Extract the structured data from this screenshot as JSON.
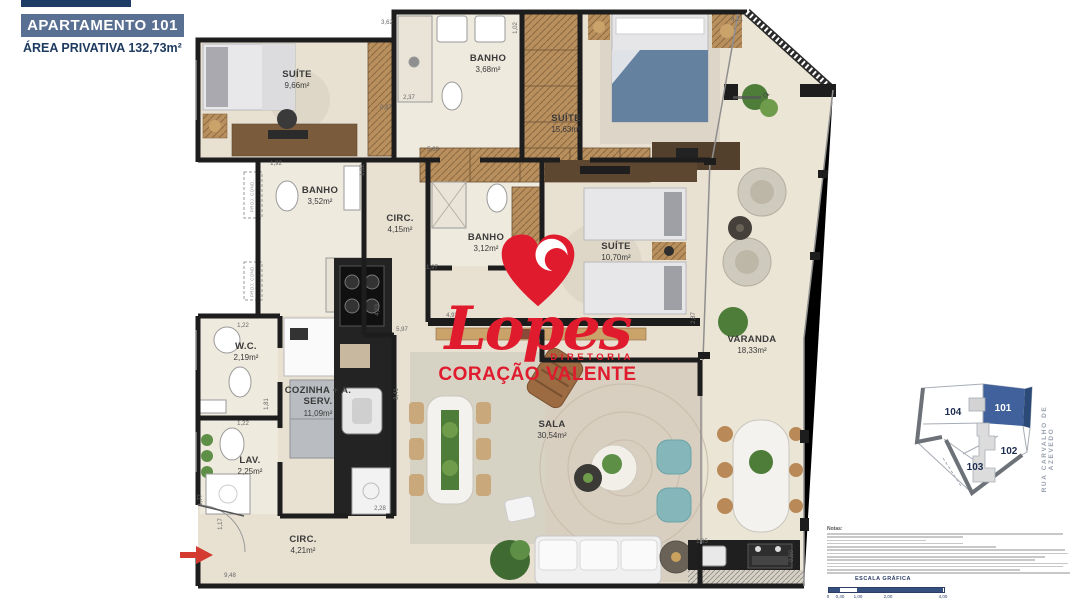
{
  "header": {
    "title": "APARTAMENTO 101",
    "subtitle": "ÁREA PRIVATIVA 132,73m²"
  },
  "logo": {
    "brand": "Lopes",
    "tagline_top": "DIRETORIA",
    "tagline_bottom": "CORAÇÃO VALENTE",
    "color": "#e11b2e"
  },
  "rooms": [
    {
      "name": "SUÍTE",
      "area": "9,66m²",
      "x": 297,
      "y": 80
    },
    {
      "name": "BANHO",
      "area": "3,68m²",
      "x": 488,
      "y": 64
    },
    {
      "name": "SUÍTE",
      "area": "15,63m²",
      "x": 566,
      "y": 124
    },
    {
      "name": "BANHO",
      "area": "3,52m²",
      "x": 320,
      "y": 196
    },
    {
      "name": "CIRC.",
      "area": "4,15m²",
      "x": 400,
      "y": 224
    },
    {
      "name": "BANHO",
      "area": "3,12m²",
      "x": 486,
      "y": 243
    },
    {
      "name": "SUÍTE",
      "area": "10,70m²",
      "x": 616,
      "y": 252
    },
    {
      "name": "W.C.",
      "area": "2,19m²",
      "x": 246,
      "y": 352
    },
    {
      "name": "COZINHA + A. SERV.",
      "area": "11,09m²",
      "x": 318,
      "y": 402
    },
    {
      "name": "LAV.",
      "area": "2,25m²",
      "x": 250,
      "y": 466
    },
    {
      "name": "CIRC.",
      "area": "4,21m²",
      "x": 303,
      "y": 545
    },
    {
      "name": "SALA",
      "area": "30,54m²",
      "x": 552,
      "y": 430
    },
    {
      "name": "VARANDA",
      "area": "18,33m²",
      "x": 752,
      "y": 345
    }
  ],
  "dimensions": [
    {
      "t": "4,21",
      "x": 737,
      "y": 20,
      "v": false
    },
    {
      "t": "3,62",
      "x": 387,
      "y": 23,
      "v": false
    },
    {
      "t": "1,02",
      "x": 516,
      "y": 28,
      "v": true
    },
    {
      "t": "2,37",
      "x": 409,
      "y": 98,
      "v": false
    },
    {
      "t": "0,87",
      "x": 386,
      "y": 108,
      "v": false
    },
    {
      "t": "5,69",
      "x": 433,
      "y": 150,
      "v": false
    },
    {
      "t": "1,92",
      "x": 276,
      "y": 164,
      "v": false
    },
    {
      "t": "1,02",
      "x": 363,
      "y": 170,
      "v": true
    },
    {
      "t": "1,97",
      "x": 432,
      "y": 268,
      "v": false
    },
    {
      "t": "2,87",
      "x": 694,
      "y": 318,
      "v": true
    },
    {
      "t": "4,93",
      "x": 452,
      "y": 316,
      "v": false
    },
    {
      "t": "5,97",
      "x": 402,
      "y": 330,
      "v": false
    },
    {
      "t": "4,23",
      "x": 378,
      "y": 310,
      "v": true
    },
    {
      "t": "1,22",
      "x": 243,
      "y": 326,
      "v": false
    },
    {
      "t": "1,81",
      "x": 267,
      "y": 404,
      "v": true
    },
    {
      "t": "1,22",
      "x": 243,
      "y": 424,
      "v": false
    },
    {
      "t": "3,41",
      "x": 397,
      "y": 394,
      "v": true
    },
    {
      "t": "2,28",
      "x": 380,
      "y": 509,
      "v": false
    },
    {
      "t": "1,77",
      "x": 201,
      "y": 500,
      "v": true
    },
    {
      "t": "1,17",
      "x": 221,
      "y": 524,
      "v": true
    },
    {
      "t": "9,48",
      "x": 230,
      "y": 576,
      "v": false
    },
    {
      "t": "1,85",
      "x": 702,
      "y": 542,
      "v": false
    },
    {
      "t": "0,60",
      "x": 792,
      "y": 556,
      "v": true
    }
  ],
  "small_labels": [
    {
      "text": "PROJ. COND.",
      "x": 252,
      "y": 196
    },
    {
      "text": "PROJ. COND.",
      "x": 252,
      "y": 281
    }
  ],
  "keyplan": {
    "units": [
      {
        "id": "104",
        "highlighted": false
      },
      {
        "id": "101",
        "highlighted": true
      },
      {
        "id": "102",
        "highlighted": false
      },
      {
        "id": "103",
        "highlighted": false
      }
    ],
    "street": "RUA CARVALHO DE AZEVEDO",
    "highlight_color": "#41619c"
  },
  "notes": {
    "title": "Notas:",
    "line_count": 13
  },
  "scale": {
    "title": "ESCALA GRÁFICA",
    "ticks": [
      "0",
      "0,40",
      "1,00",
      "2,00",
      "4,00"
    ]
  },
  "colors": {
    "wall": "#1d1d1d",
    "floor": "#e8e0d1",
    "bath_floor": "#efeade",
    "veranda_floor": "#ebe5d6",
    "accent_red": "#e11b2e",
    "header_box": "#5a7093",
    "header_text": "#1d3a5f",
    "keyplan_blue": "#41619c",
    "scale_blue": "#2c3e66"
  }
}
